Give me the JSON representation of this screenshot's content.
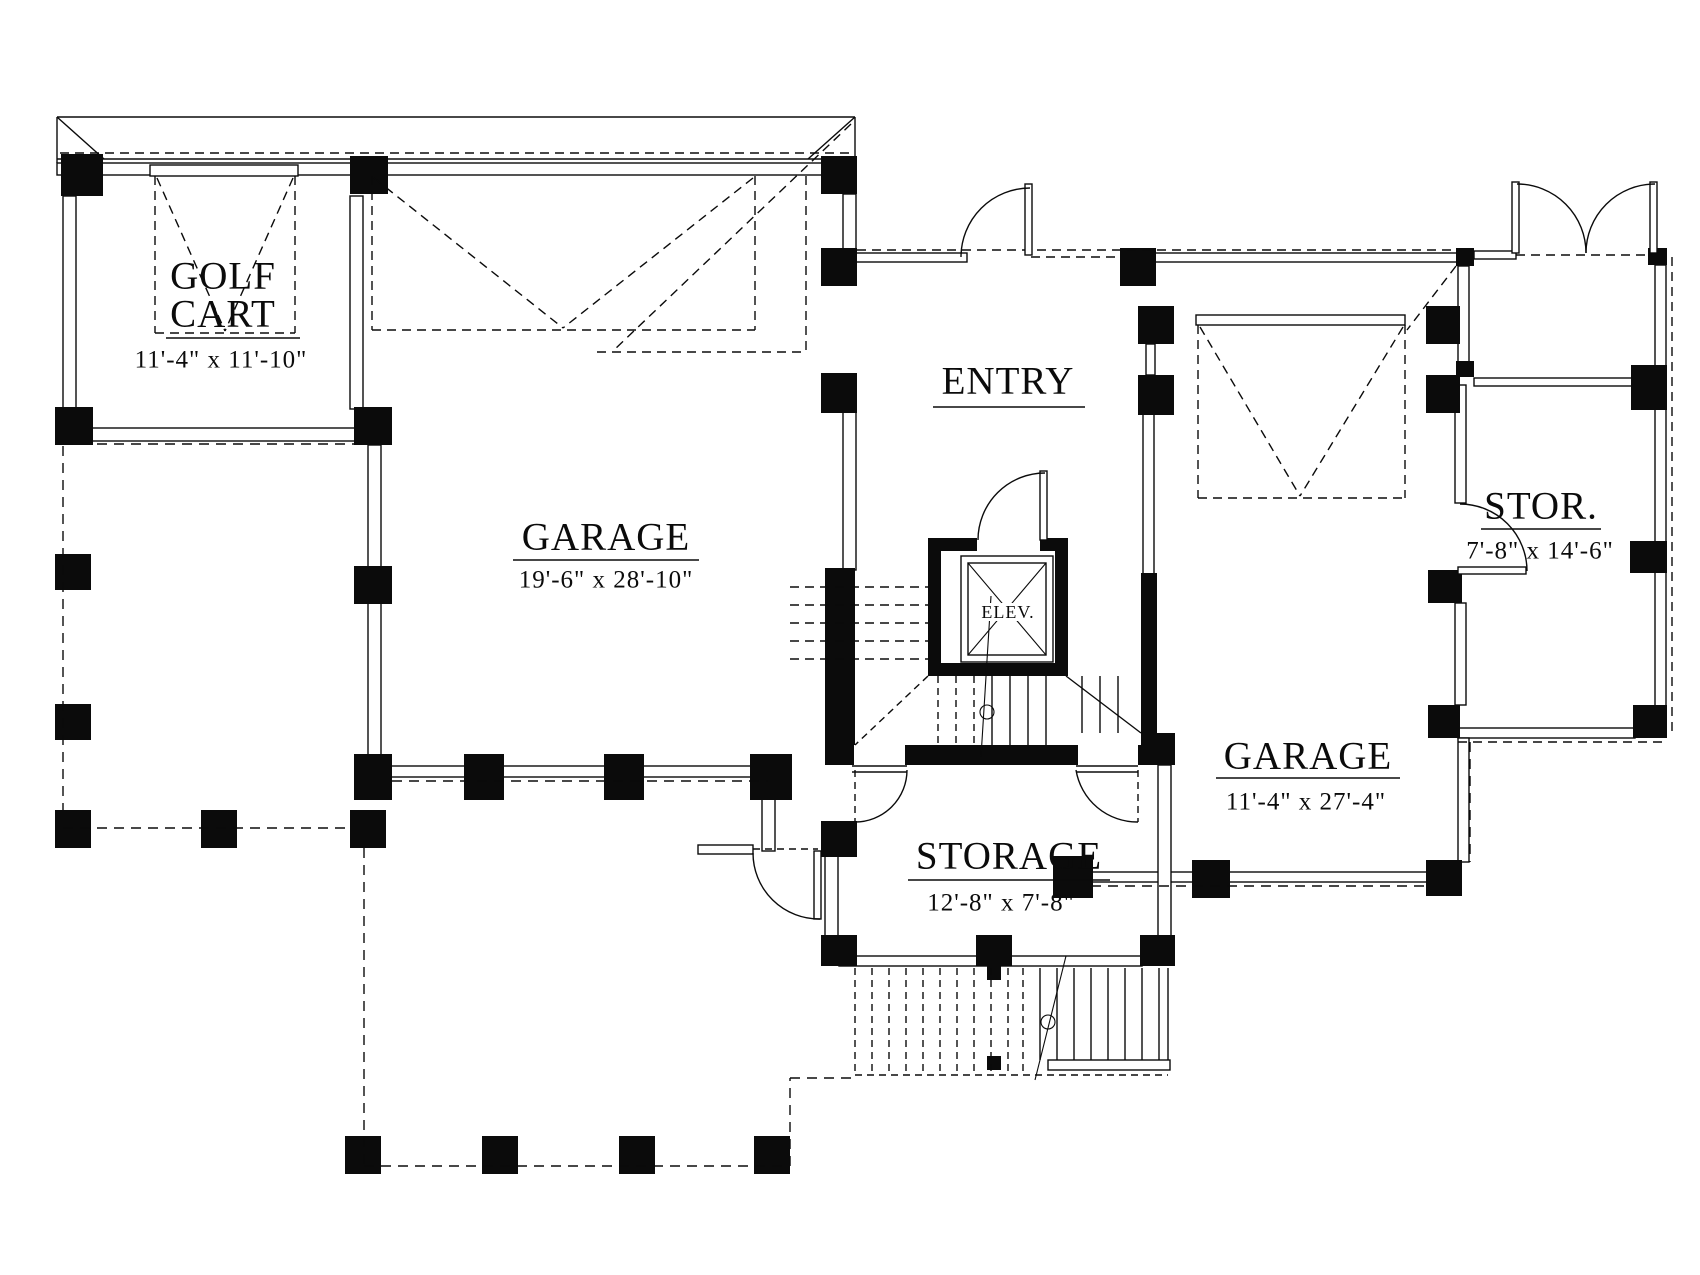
{
  "drawing": {
    "type": "floor-plan",
    "ink_color": "#0b0b0b",
    "paper_color": "#ffffff"
  },
  "rooms": {
    "golf_cart": {
      "line1": "GOLF",
      "line2": "CART",
      "dimensions": "11'-4\" x 11'-10\""
    },
    "garage_left": {
      "label": "GARAGE",
      "dimensions": "19'-6\" x 28'-10\""
    },
    "entry": {
      "label": "ENTRY"
    },
    "elevator": {
      "label": "ELEV."
    },
    "storage_right": {
      "label": "STOR.",
      "dimensions": "7'-8\" x 14'-6\""
    },
    "garage_right": {
      "label": "GARAGE",
      "dimensions": "11'-4\" x 27'-4\""
    },
    "storage_bottom": {
      "label": "STORAGE",
      "dimensions": "12'-8\" x 7'-8\""
    }
  }
}
